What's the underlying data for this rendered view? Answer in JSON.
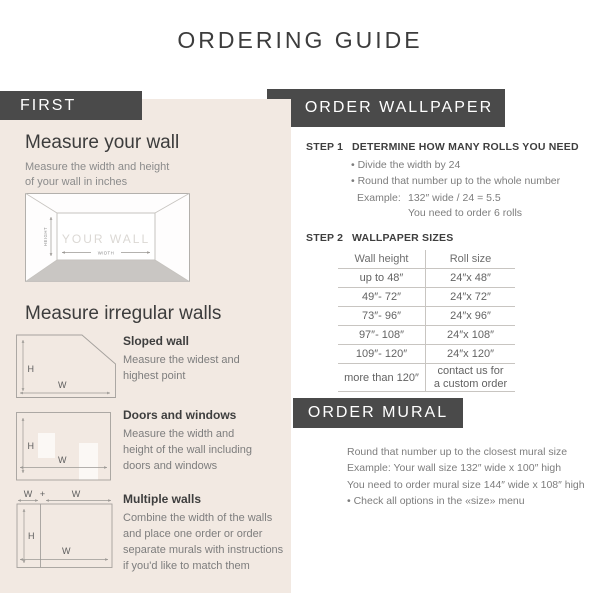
{
  "page": {
    "title": "ORDERING GUIDE"
  },
  "colors": {
    "accent_dark": "#4a4a4a",
    "panel_beige": "#f2e9e2",
    "heading_text": "#3c3c3c",
    "body_text": "#7d7d7d",
    "diagram_line": "#a5a19d",
    "floor_gray": "#c9c6c3"
  },
  "first_section": {
    "header_label": "FIRST",
    "measure_wall_title": "Measure your wall",
    "measure_wall_subtitle": "Measure the width and height\nof your wall in inches",
    "wall_diagram": {
      "label": "YOUR WALL",
      "width_label": "WIDTH",
      "height_label": "HEIGHT"
    },
    "irregular_title": "Measure irregular walls",
    "diagram_labels": {
      "h": "H",
      "w": "W",
      "plus": "+"
    },
    "items": [
      {
        "title": "Sloped wall",
        "description": "Measure the widest and\nhighest point"
      },
      {
        "title": "Doors and windows",
        "description": "Measure the width and\nheight of the wall including\ndoors and windows"
      },
      {
        "title": "Multiple walls",
        "description": "Combine the width of the walls\nand place one order or order\nseparate murals with instructions\nif you'd like to match them"
      }
    ]
  },
  "order_wallpaper": {
    "header_label": "ORDER WALLPAPER",
    "step1_label": "STEP 1",
    "step1_title": "DETERMINE HOW MANY ROLLS YOU NEED",
    "step1_bullets": [
      "• Divide the width by 24",
      "• Round that number up to the whole number"
    ],
    "example_label": "Example:",
    "example_value": "132″ wide / 24 = 5.5",
    "example_result": "You need to order 6 rolls",
    "step2_label": "STEP 2",
    "step2_title": "WALLPAPER SIZES",
    "table": {
      "col1_header": "Wall height",
      "col2_header": "Roll size",
      "rows": [
        {
          "wall_height": "up to 48″",
          "roll_size": "24″x 48″"
        },
        {
          "wall_height": "49″- 72″",
          "roll_size": "24″x 72″"
        },
        {
          "wall_height": "73″- 96″",
          "roll_size": "24″x 96″"
        },
        {
          "wall_height": "97″- 108″",
          "roll_size": "24″x 108″"
        },
        {
          "wall_height": "109″- 120″",
          "roll_size": "24″x 120″"
        },
        {
          "wall_height": "more than 120″",
          "roll_size": "contact us for\na custom order"
        }
      ]
    }
  },
  "order_mural": {
    "header_label": "ORDER MURAL",
    "lines": [
      "Round that number up to the closest mural size",
      "Example: Your wall size 132″ wide x 100″ high",
      "You need to order mural size 144″ wide x 108″ high",
      "• Check all options in the «size» menu"
    ]
  }
}
